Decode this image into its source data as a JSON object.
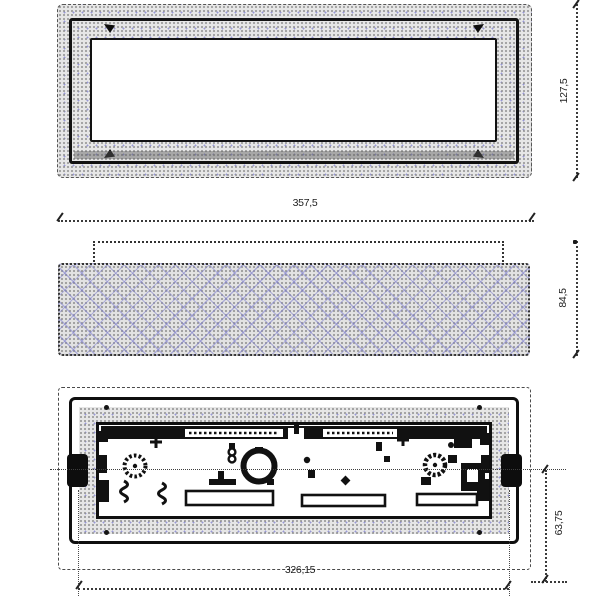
{
  "drawing": {
    "dimensions": {
      "front_width": "357,5",
      "front_height": "127,5",
      "side_height": "84,5",
      "back_mount_width": "326,15",
      "back_half_height": "63,75"
    },
    "colors": {
      "line": "#1b1b1b",
      "stipple_base": "#e6e6e6",
      "stipple_dot": "#8f8f8f",
      "hatch_accent": "#9a9ad6",
      "background": "#ffffff"
    }
  }
}
